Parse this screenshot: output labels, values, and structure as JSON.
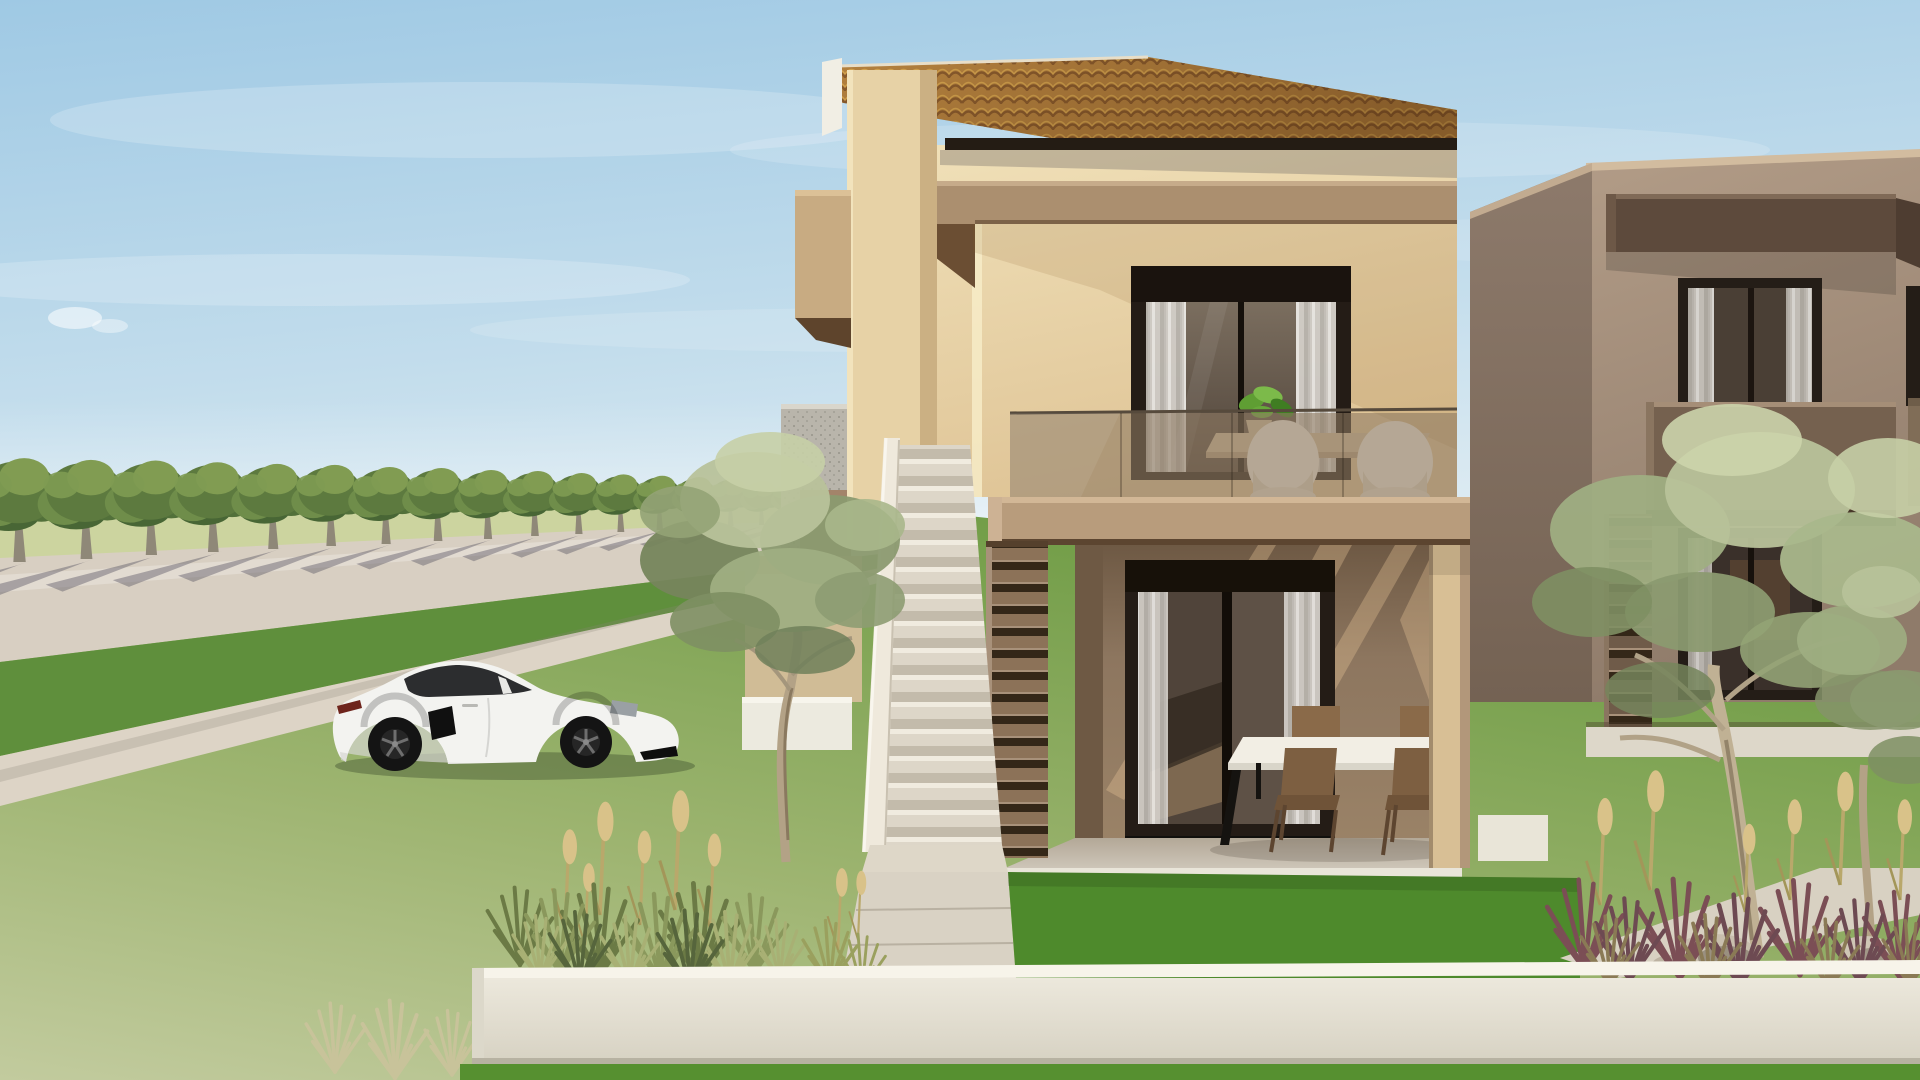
{
  "scene": {
    "type": "3d-architectural-rendering",
    "description": "Exterior render of a modern two-storey cream house with terracotta tile roof, external staircase, glass-railed balcony and covered patio; white sports coupe parked on the lawn beside a tree-lined street; taupe neighbouring house on the right; olive trees, ornamental grasses and a low white garden wall in the foreground",
    "time_of_day": "late-afternoon sun from the right",
    "objects": {
      "main_house": "two-storey cream villa with terracotta roof",
      "neighbor_house": "taupe two-storey house, right side",
      "car": "white sports coupe with black wheels",
      "street_trees": "row of trees receding along the road",
      "street": "light concrete road with tree shadows",
      "staircase": "external white staircase to balcony",
      "louver_screen": "slatted screen beside the stairs",
      "balcony": "upper terrace with glass railing, two white chairs, table and plant",
      "patio": "ground-floor covered terrace with white dining table and four wooden chairs",
      "olive_trees": "silver-green olive trees in the garden",
      "grasses": "ornamental grasses with golden plumes and burgundy tufts",
      "rocks": "light boulders among the grasses",
      "garden_wall": "low white boundary wall in the foreground"
    }
  },
  "colors": {
    "sky_top": "#9fc9e4",
    "sky_mid": "#c3ddec",
    "sky_horizon": "#e8f1f5",
    "field": "#ccd49f",
    "canopy": "#5d7a3f",
    "canopy_light": "#819c52",
    "trunk": "#8f8878",
    "road": "#d8cfc2",
    "grass_mid": "#5f8f3c",
    "sidewalk": "#ddd4c6",
    "lawn_sage": "#c2cb9e",
    "lawn_green": "#6f9c45",
    "lawn_bright": "#4e8a2c",
    "walkway": "#d9d2c4",
    "car_body": "#f3f3f0",
    "car_window": "#2c2d2f",
    "car_wheel": "#141414",
    "roof_tile": "#b5823f",
    "roof_trim": "#f1eee4",
    "gutter": "#241c14",
    "wall_light": "#f0e0b8",
    "wall_shade": "#dfc496",
    "pillar": "#e7d2a6",
    "fascia": "#ab8f6f",
    "fascia_dark": "#6b4e33",
    "band": "#b89c7c",
    "frame_dark": "#241c16",
    "curtain": "#d6d2cc",
    "balcony_glass": "#8d7a63",
    "terrace_wall": "#8d765f",
    "terrace_floor": "#cdc5b8",
    "parapet": "#efe9dc",
    "louver": "#8c7258",
    "table_top": "#f2eee4",
    "chair_wood": "#8a6a49",
    "chair_white": "#f1ece0",
    "neighbor_front": "#a7927f",
    "neighbor_side": "#8d7a6b",
    "neighbor_awning": "#5d4a3c",
    "neighbor_parapet": "#75614f",
    "plinth": "#ddd7c9",
    "olive_leaf": "#9fae82",
    "olive_leaf_light": "#b8c29a",
    "olive_leaf_dark": "#76855c",
    "olive_trunk": "#b3a286",
    "plume": "#d9c289",
    "tuft_burgundy": "#7b4e55",
    "rock": "#c9bfae",
    "front_wall": "#ece8dc",
    "grass_strip": "#569030",
    "speckle_wall": "#b9b5ab",
    "panel_brown": "#a3846a"
  }
}
